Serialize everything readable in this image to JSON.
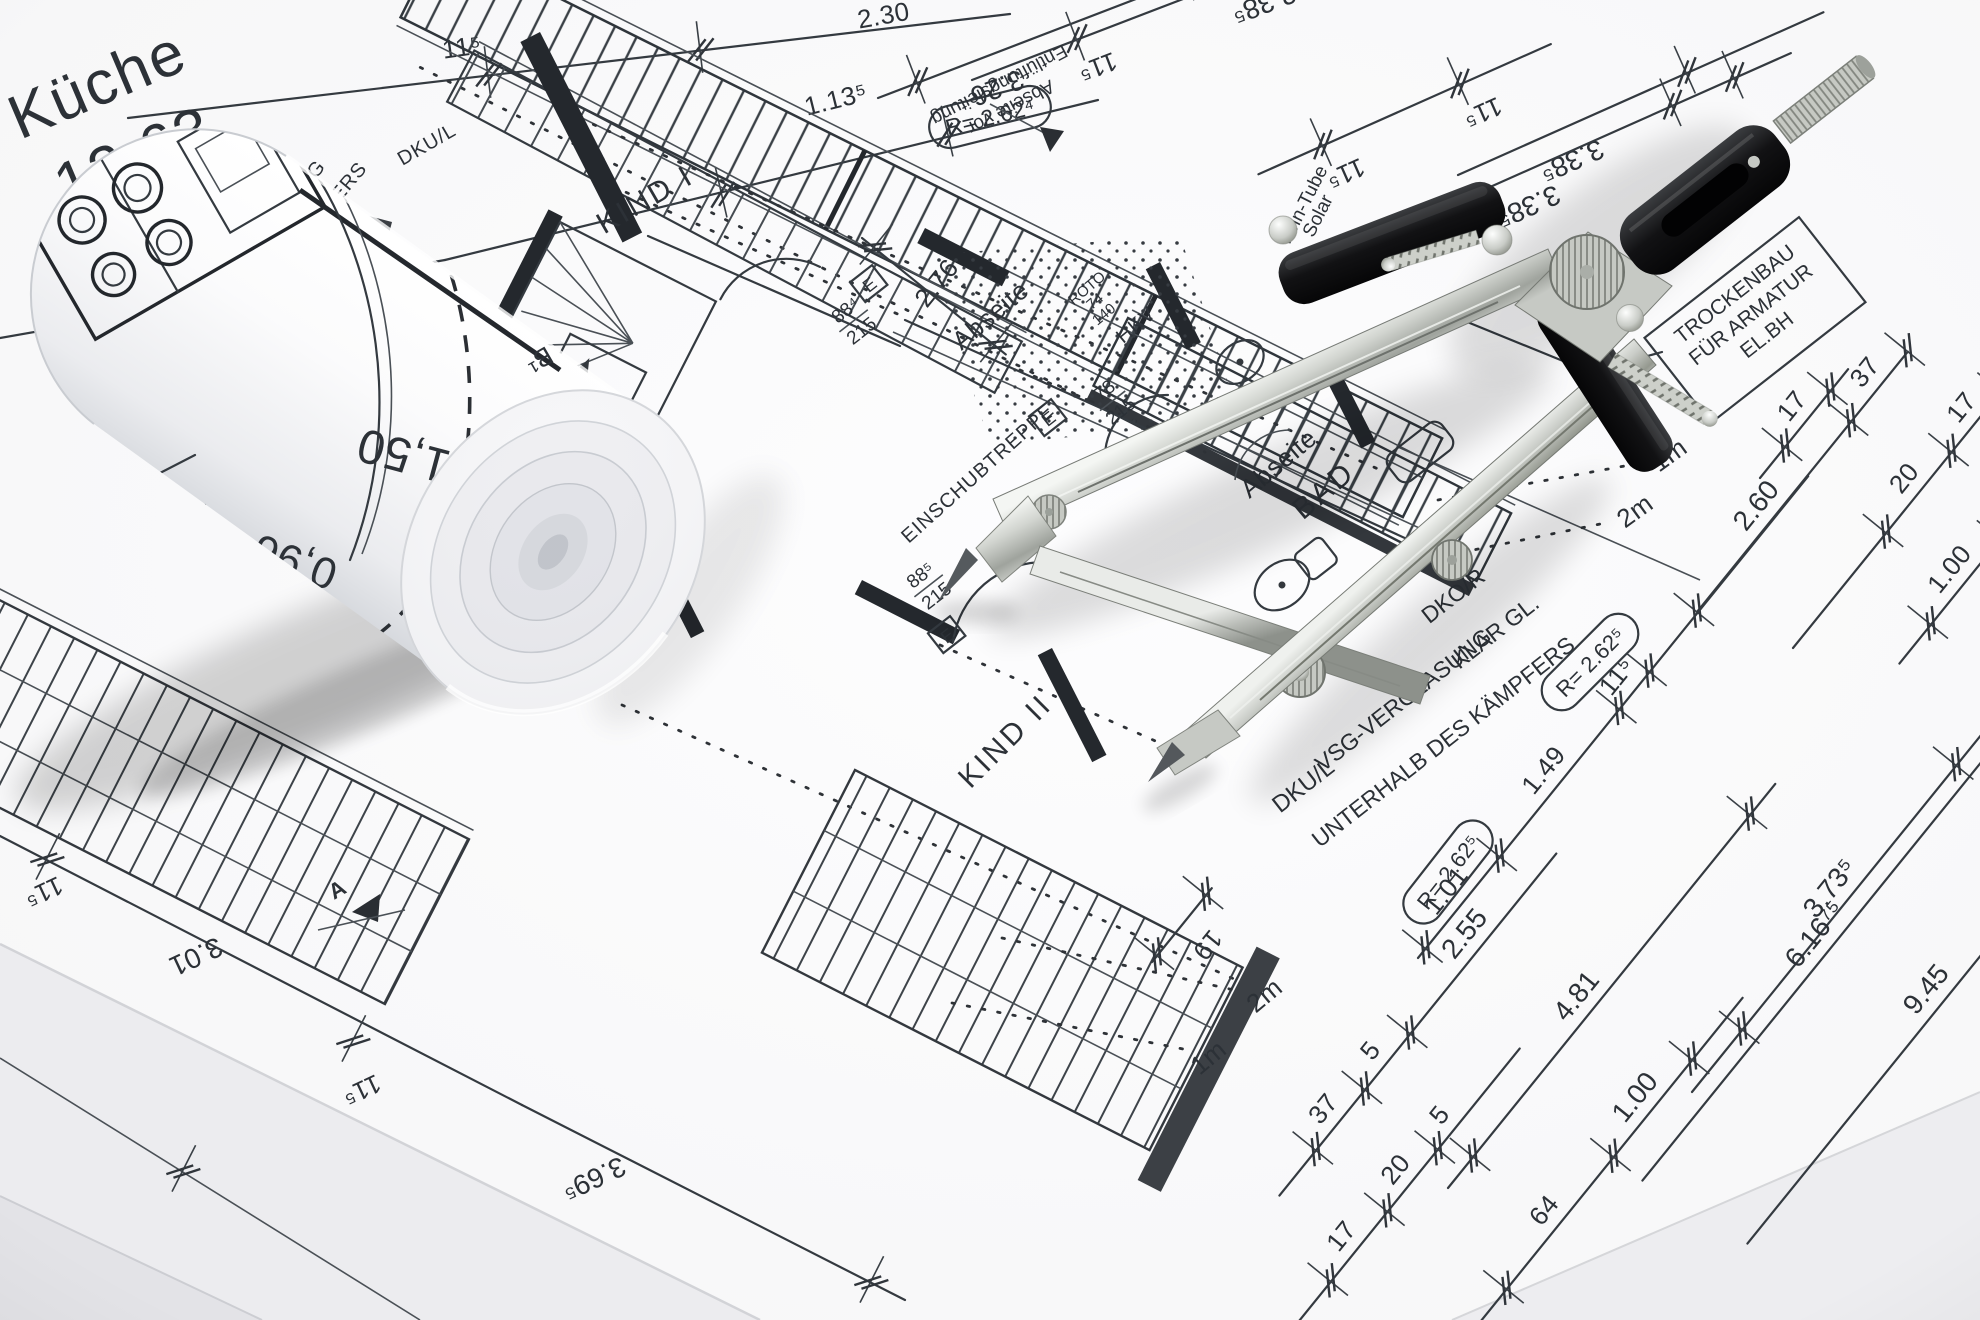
{
  "labels": {
    "kueche": "Küche",
    "kueche_area": "12,63",
    "kind1": "KIND I",
    "kind2": "KIND II",
    "bad": "BAD",
    "abseite": "Abseite",
    "einschubtreppe": "EINSCHUBTREPPE",
    "abseite_vor_1": "Abseite vor",
    "abseite_vor_2": "Entlüftungsleitung",
    "twin1": "Twin-Tube",
    "twin2": "Solar",
    "trocken1": "TROCKENBAU",
    "trocken2": "FÜR ARMATUR",
    "trocken3": "EL.BH",
    "vsg1": "VSG-VERGLASUNG",
    "vsg1b": "KLAR GL.",
    "vsg2": "UNTERHALB DES KÄMPFERS",
    "dkor": "DKO/R",
    "dkul": "DKU/L",
    "roto": "ROTO",
    "roto74": "74",
    "roto140": "140",
    "hkv": "HKV",
    "asung": "ASUNG",
    "kaempfers": "KÄMPFERS",
    "stg": "Stg",
    "b1": "B¹",
    "e": "E",
    "a": "A"
  },
  "doors": {
    "d88a": "88⁴",
    "d78": "78",
    "d88b": "88⁵",
    "h215": "215"
  },
  "radius": {
    "r4": "R= 2.62⁴",
    "r5": "R= 2.62⁵"
  },
  "dims": {
    "d230": "2.30",
    "d113": "1.13⁵",
    "d115": "11⁵",
    "d326": "3.26",
    "d238": "2.38⁵",
    "d338": "3.38⁵",
    "d276": "2.76",
    "d260": "2.60",
    "d373": "3.73⁵",
    "d101": "1.01",
    "d149": "1.49",
    "d616": "6.16⁷⁵",
    "d945": "9.45",
    "d481": "4.81",
    "d255": "2.55",
    "d100": "1.00",
    "d64": "64",
    "d17": "17",
    "d20": "20",
    "d37": "37",
    "d5": "5",
    "d19": "19",
    "d301": "3.01",
    "d369": "3.69⁵",
    "d150": "1,50",
    "d096": "0,96",
    "m1": "1m",
    "m2": "2m"
  }
}
